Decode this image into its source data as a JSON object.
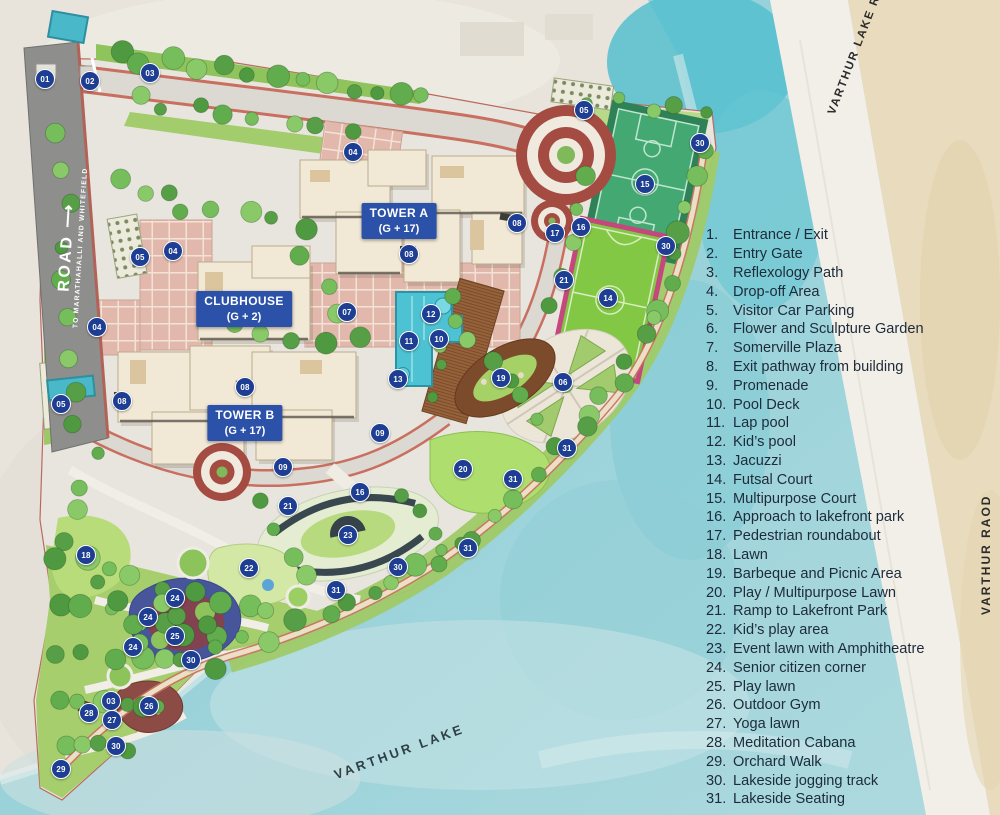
{
  "map": {
    "road_left": {
      "name": "ROAD",
      "arrow": "⟶",
      "destination": "TO MARATHAHALLI AND WHITEFIELD"
    },
    "road_top_right": "VARTHUR LAKE RAOD",
    "road_right": "VARTHUR RAOD",
    "lake_label": "VARTHUR LAKE",
    "buildings": [
      {
        "label": "TOWER A",
        "floors": "(G + 17)"
      },
      {
        "label": "CLUBHOUSE",
        "floors": "(G + 2)"
      },
      {
        "label": "TOWER B",
        "floors": "(G + 17)"
      }
    ],
    "markers": [
      {
        "n": "01",
        "x": 45,
        "y": 79
      },
      {
        "n": "02",
        "x": 90,
        "y": 81
      },
      {
        "n": "03",
        "x": 150,
        "y": 73
      },
      {
        "n": "03",
        "x": 111,
        "y": 701
      },
      {
        "n": "04",
        "x": 353,
        "y": 152
      },
      {
        "n": "04",
        "x": 173,
        "y": 251
      },
      {
        "n": "04",
        "x": 97,
        "y": 327
      },
      {
        "n": "05",
        "x": 584,
        "y": 110
      },
      {
        "n": "05",
        "x": 140,
        "y": 257
      },
      {
        "n": "05",
        "x": 61,
        "y": 404
      },
      {
        "n": "06",
        "x": 563,
        "y": 382
      },
      {
        "n": "07",
        "x": 347,
        "y": 312
      },
      {
        "n": "08",
        "x": 517,
        "y": 223
      },
      {
        "n": "08",
        "x": 409,
        "y": 254
      },
      {
        "n": "08",
        "x": 245,
        "y": 387
      },
      {
        "n": "08",
        "x": 122,
        "y": 401
      },
      {
        "n": "09",
        "x": 380,
        "y": 433
      },
      {
        "n": "09",
        "x": 283,
        "y": 467
      },
      {
        "n": "10",
        "x": 439,
        "y": 339
      },
      {
        "n": "11",
        "x": 409,
        "y": 341
      },
      {
        "n": "12",
        "x": 431,
        "y": 314
      },
      {
        "n": "13",
        "x": 398,
        "y": 379
      },
      {
        "n": "14",
        "x": 608,
        "y": 298
      },
      {
        "n": "15",
        "x": 645,
        "y": 184
      },
      {
        "n": "16",
        "x": 581,
        "y": 227
      },
      {
        "n": "16",
        "x": 360,
        "y": 492
      },
      {
        "n": "17",
        "x": 555,
        "y": 233
      },
      {
        "n": "18",
        "x": 86,
        "y": 555
      },
      {
        "n": "19",
        "x": 501,
        "y": 378
      },
      {
        "n": "20",
        "x": 463,
        "y": 469
      },
      {
        "n": "21",
        "x": 564,
        "y": 280
      },
      {
        "n": "21",
        "x": 288,
        "y": 506
      },
      {
        "n": "22",
        "x": 249,
        "y": 568
      },
      {
        "n": "23",
        "x": 348,
        "y": 535
      },
      {
        "n": "24",
        "x": 175,
        "y": 598
      },
      {
        "n": "24",
        "x": 148,
        "y": 617
      },
      {
        "n": "24",
        "x": 133,
        "y": 647
      },
      {
        "n": "25",
        "x": 175,
        "y": 636
      },
      {
        "n": "26",
        "x": 149,
        "y": 706
      },
      {
        "n": "27",
        "x": 112,
        "y": 720
      },
      {
        "n": "28",
        "x": 89,
        "y": 713
      },
      {
        "n": "29",
        "x": 61,
        "y": 769
      },
      {
        "n": "30",
        "x": 700,
        "y": 143
      },
      {
        "n": "30",
        "x": 666,
        "y": 246
      },
      {
        "n": "30",
        "x": 398,
        "y": 567
      },
      {
        "n": "30",
        "x": 191,
        "y": 660
      },
      {
        "n": "30",
        "x": 116,
        "y": 746
      },
      {
        "n": "31",
        "x": 567,
        "y": 448
      },
      {
        "n": "31",
        "x": 513,
        "y": 479
      },
      {
        "n": "31",
        "x": 468,
        "y": 548
      },
      {
        "n": "31",
        "x": 336,
        "y": 590
      }
    ]
  },
  "legend": {
    "items": [
      {
        "num": "1.",
        "label": "Entrance / Exit"
      },
      {
        "num": "2.",
        "label": "Entry Gate"
      },
      {
        "num": "3.",
        "label": "Reflexology Path"
      },
      {
        "num": "4.",
        "label": "Drop-off Area"
      },
      {
        "num": "5.",
        "label": "Visitor Car Parking"
      },
      {
        "num": "6.",
        "label": "Flower and Sculpture Garden"
      },
      {
        "num": "7.",
        "label": "Somerville Plaza"
      },
      {
        "num": "8.",
        "label": "Exit pathway from building"
      },
      {
        "num": "9.",
        "label": "Promenade"
      },
      {
        "num": "10.",
        "label": "Pool Deck"
      },
      {
        "num": "11.",
        "label": "Lap pool"
      },
      {
        "num": "12.",
        "label": "Kid’s pool"
      },
      {
        "num": "13.",
        "label": "Jacuzzi"
      },
      {
        "num": "14.",
        "label": "Futsal Court"
      },
      {
        "num": "15.",
        "label": "Multipurpose Court"
      },
      {
        "num": "16.",
        "label": "Approach to lakefront park"
      },
      {
        "num": "17.",
        "label": "Pedestrian roundabout"
      },
      {
        "num": "18.",
        "label": "Lawn"
      },
      {
        "num": "19.",
        "label": "Barbeque and Picnic Area"
      },
      {
        "num": "20.",
        "label": "Play / Multipurpose Lawn"
      },
      {
        "num": "21.",
        "label": "Ramp to Lakefront Park"
      },
      {
        "num": "22.",
        "label": "Kid’s play area"
      },
      {
        "num": "23.",
        "label": "Event lawn with Amphitheatre"
      },
      {
        "num": "24.",
        "label": "Senior citizen corner"
      },
      {
        "num": "25.",
        "label": "Play lawn"
      },
      {
        "num": "26.",
        "label": "Outdoor Gym"
      },
      {
        "num": "27.",
        "label": "Yoga lawn"
      },
      {
        "num": "28.",
        "label": "Meditation Cabana"
      },
      {
        "num": "29.",
        "label": "Orchard Walk"
      },
      {
        "num": "30.",
        "label": "Lakeside jogging track"
      },
      {
        "num": "31.",
        "label": "Lakeside Seating"
      }
    ]
  },
  "colors": {
    "marker_bg": "#1d3e92",
    "building_label_bg": "#2b51a8",
    "legend_text": "#1d2b3a",
    "lake": "#8fccd6",
    "court_green": "#44a873",
    "futsal_green": "#83c844",
    "futsal_border": "#c4487e",
    "pool_teal": "#4cc2d2",
    "roundabout_red": "#a44b42",
    "plaza_pink": "#e2b8ac",
    "building_cream": "#f1e8d6"
  }
}
